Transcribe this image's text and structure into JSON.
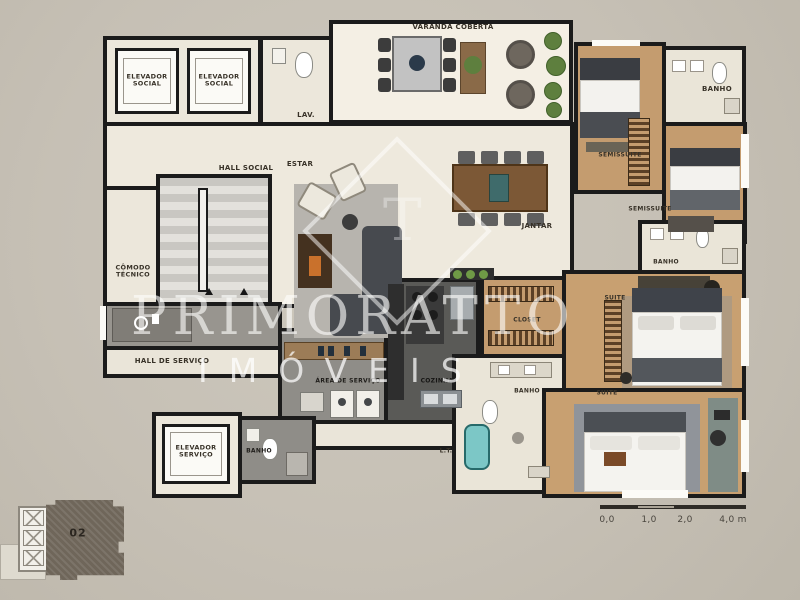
{
  "watermark": {
    "brand": "PRIMORATTO",
    "sub": "IMÓVEIS",
    "monogram": "T"
  },
  "rooms": {
    "varanda": "VARANDA COBERTA",
    "elevador_social_1": "ELEVADOR SOCIAL",
    "elevador_social_2": "ELEVADOR SOCIAL",
    "lav": "LAV.",
    "hall_social": "HALL SOCIAL",
    "estar": "ESTAR",
    "jantar": "JANTAR",
    "banho_superior": "BANHO",
    "semissuite_1": "SEMISSUITE",
    "semissuite_2": "SEMISSUITE",
    "comodo_tecnico": "CÔMODO TÉCNICO",
    "hall_servico": "HALL DE SERVIÇO",
    "area_servico": "ÁREA DE SERVIÇO",
    "cozinha": "COZINHA",
    "closet": "CLOSET",
    "banho_suite_media": "BANHO",
    "banho_master": "BANHO",
    "banho_servico": "BANHO",
    "suite_media": "SUITE",
    "suite_master": "SUITE",
    "lavanderia_tanque": "L.T.",
    "elevador_servico": "ELEVADOR SERVIÇO"
  },
  "scale_bar": {
    "tick_0": "0,0",
    "tick_1": "1,0",
    "tick_2": "2,0",
    "tick_end": "4,0 m"
  },
  "key_plan": {
    "unit_number": "02"
  },
  "colors": {
    "wall": "#1b1b1b",
    "floor_light": "#ece7db",
    "wood": "#c49c6f",
    "kitchen_dark": "#5a5a57",
    "service_gray": "#8f8d88",
    "tub_blue": "#7cc7c6",
    "greenery": "#5e7f3e",
    "keyplan_unit": "#6f665a",
    "watermark_white": "#ffffff"
  }
}
